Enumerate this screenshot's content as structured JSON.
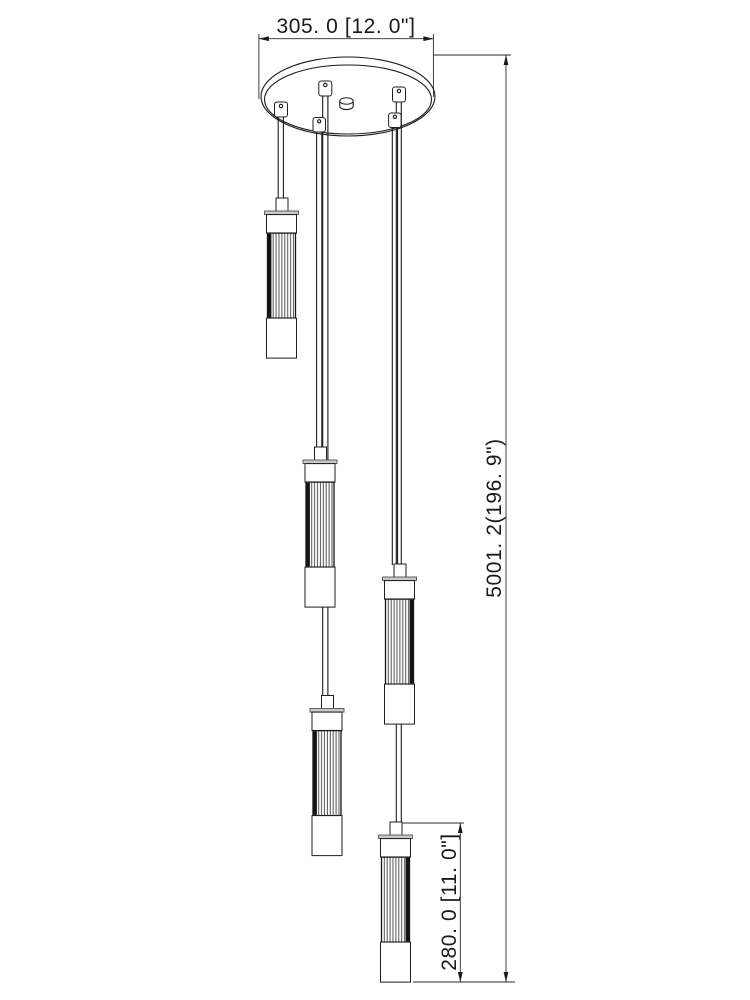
{
  "drawing": {
    "subject": "multi-pendant light fixture dimension drawing",
    "pendant_count": 5,
    "colors": {
      "background": "#ffffff",
      "line": "#1a1a1a",
      "cap_strip_gray": "#c9c9c9",
      "rib_dark_band": "#141414"
    },
    "dimensions": {
      "canopy_width": {
        "label": "305. 0 [12. 0\"]",
        "value_mm": "305.0",
        "value_in": "12.0\""
      },
      "overall_height": {
        "label": "5001. 2(196. 9\")",
        "value_mm": "5001.2",
        "value_in": "196.9\""
      },
      "pendant_length": {
        "label": "280. 0 [11. 0\"]",
        "value_mm": "280.0",
        "value_in": "11.0\""
      }
    }
  }
}
